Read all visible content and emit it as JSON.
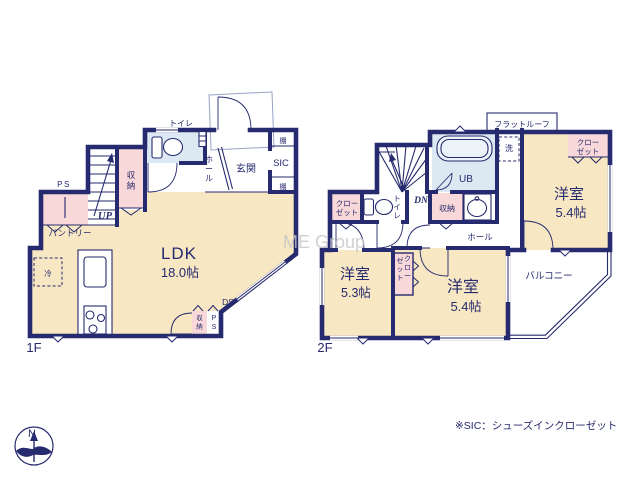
{
  "colors": {
    "wall_navy": "#262a6e",
    "room_cream": "#f7e7c3",
    "closet_pink": "#f9d8da",
    "wet_area_blue": "#dce8f2",
    "watermark_gray": "#c5c5ca"
  },
  "watermark": "ME Group",
  "note": "※SIC：シューズインクローゼット",
  "compass": {
    "north": "N"
  },
  "floor1": {
    "floor_label": "1F",
    "ldk": {
      "name": "LDK",
      "size": "18.0帖"
    },
    "toilet": "トイレ",
    "hall": "ホール",
    "entrance": "玄関",
    "sic": "SIC",
    "shelf_top": "棚",
    "shelf_bottom": "棚",
    "storage_mid": "収納",
    "storage_bottom": "収納",
    "pantry": "パントリー",
    "ps_top": "PS",
    "ps_bottom": "PS",
    "up": "UP",
    "ds": "DS",
    "fridge": "冷"
  },
  "floor2": {
    "floor_label": "2F",
    "flat_roof": "フラットルーフ",
    "washer": "洗",
    "bath": "UB",
    "toilet": "トイレ",
    "storage": "収納",
    "hall": "ホール",
    "dn": "DN",
    "closet_top_right_1": "クロー",
    "closet_top_right_2": "ゼット",
    "closet_left_1": "クロー",
    "closet_left_2": "ゼット",
    "closet_center_1": "クロー",
    "closet_center_2": "ゼット",
    "room_top_right": {
      "name": "洋室",
      "size": "5.4帖"
    },
    "room_left": {
      "name": "洋室",
      "size": "5.3帖"
    },
    "room_center": {
      "name": "洋室",
      "size": "5.4帖"
    },
    "balcony": "バルコニー"
  }
}
